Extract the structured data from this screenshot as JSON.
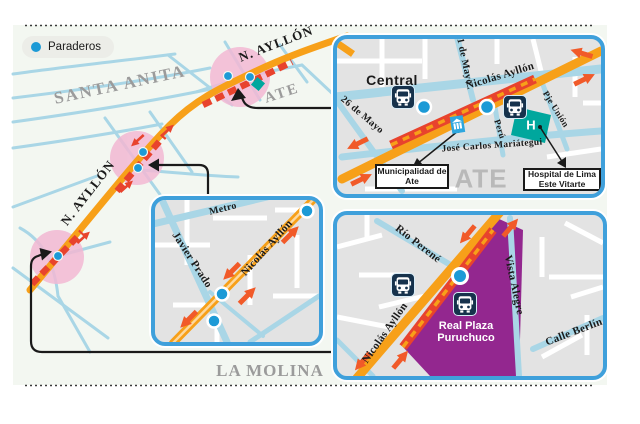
{
  "legend": {
    "label": "Paraderos"
  },
  "main_map": {
    "santa_anita": "SANTA ANITA",
    "ate": "ATE",
    "la_molina": "LA MOLINA",
    "n_ayllon_top": "N. AYLLÓN",
    "n_ayllon_left": "N. AYLLÓN"
  },
  "inset_central": {
    "central": "Central",
    "nicolas_ayllon": "Nicolás Ayllón",
    "mayo26": "26 de Mayo",
    "mayo21": "21 de Mayo",
    "peru": "Perú",
    "pje_union": "Pje Unión",
    "mariategui": "José Carlos Mariátegui",
    "ate": "ATE",
    "h": "H",
    "box_municipalidad": "Municipalidad de Ate",
    "box_hospital": "Hospital de Lima Este Vitarte"
  },
  "inset_javier_prado": {
    "metro": "Metro",
    "javier_prado": "Javier Prado",
    "nicolas_ayllon": "Nicolás Ayllón"
  },
  "inset_puruchuco": {
    "rio_perene": "Río Perené",
    "nicolas_ayllon": "Nicolás Ayllón",
    "vista_alegre": "Vista Alegre",
    "calle_berlin": "Calle Berlín",
    "real_plaza": "Real Plaza Puruchuco"
  },
  "colors": {
    "road_orange": "#F7A019",
    "route_red": "#E8432D",
    "arrow_orange": "#F15A29",
    "paradero_blue": "#1C9AD6",
    "street_blue": "#A9D6E6",
    "highlight_pink": "#F2B8D3",
    "mall_purple": "#93278F",
    "hospital_teal": "#00A79D",
    "bus_navy": "#16324C",
    "inset_border_blue": "#3FA0DB",
    "district_gray": "#9B9B9B"
  }
}
